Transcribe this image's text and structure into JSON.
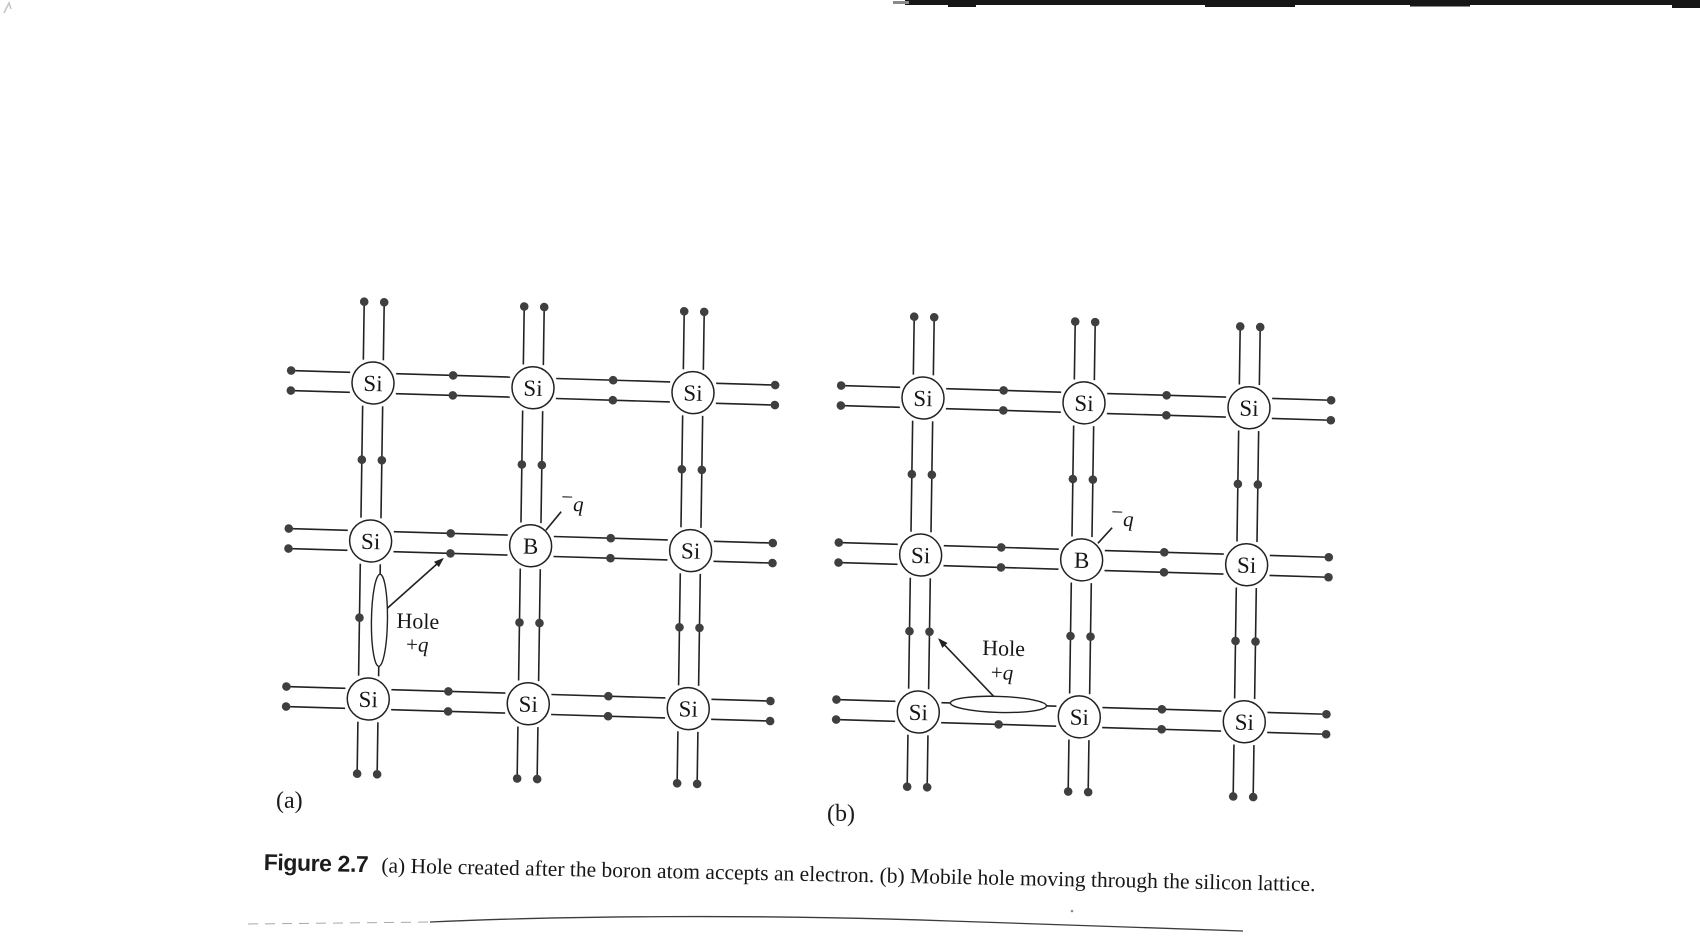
{
  "page": {
    "background": "#ffffff"
  },
  "caption": {
    "figure_label": "Figure 2.7",
    "text": "(a) Hole created after the boron atom accepts an electron. (b) Mobile hole moving through the silicon lattice."
  },
  "artifacts": {
    "top_bar_color": "#161616",
    "bottom_line_color": "#3b3b3b",
    "faint_line_color": "#a9a9a9",
    "corner_mark_color": "#c4c4c4"
  },
  "geometry": {
    "atom_radius": 21,
    "pair_offset": 10,
    "dot_radius": 4.3,
    "line_width": 1.6,
    "stroke": "#222222",
    "dot_color": "#3f3f3f",
    "skew": [
      1,
      0.03,
      -0.015,
      1
    ]
  },
  "diagrams": [
    {
      "id": "a",
      "sublabel": "(a)",
      "origin": {
        "x": 373,
        "y": 383
      },
      "cols": [
        0,
        160,
        320
      ],
      "rows": [
        0,
        158,
        316
      ],
      "atoms": [
        [
          "Si",
          "Si",
          "Si"
        ],
        [
          "Si",
          "B",
          "Si"
        ],
        [
          "Si",
          "Si",
          "Si"
        ]
      ],
      "hole": {
        "orientation": "vertical",
        "cx": 10,
        "cy": 237,
        "rx": 8,
        "ry": 46
      },
      "hole_label": {
        "word": "Hole",
        "charge_plus": "+",
        "charge_q": "q",
        "word_pos": {
          "x": 27,
          "y": 244
        },
        "charge_pos": {
          "x": 37,
          "y": 267
        }
      },
      "arrow": {
        "x1": 12,
        "y1": 230,
        "x2": 72,
        "y2": 174
      },
      "acceptor_label": {
        "minus": "−",
        "q": "q",
        "pos": {
          "x": 190,
          "y": 122
        },
        "leader": {
          "x1": 175,
          "y1": 142,
          "x2": 190,
          "y2": 123
        }
      }
    },
    {
      "id": "b",
      "sublabel": "(b)",
      "origin": {
        "x": 923,
        "y": 398
      },
      "cols": [
        0,
        161,
        326
      ],
      "rows": [
        0,
        157,
        314
      ],
      "atoms": [
        [
          "Si",
          "Si",
          "Si"
        ],
        [
          "Si",
          "B",
          "Si"
        ],
        [
          "Si",
          "Si",
          "Si"
        ]
      ],
      "hole": {
        "orientation": "horizontal",
        "cx": 80,
        "cy": 304,
        "rx": 48,
        "ry": 8
      },
      "hole_label": {
        "word": "Hole",
        "charge_plus": "+",
        "charge_q": "q",
        "word_pos": {
          "x": 63,
          "y": 255
        },
        "charge_pos": {
          "x": 72,
          "y": 279
        }
      },
      "arrow": {
        "x1": 78,
        "y1": 299,
        "x2": 20,
        "y2": 241
      },
      "acceptor_label": {
        "minus": "−",
        "q": "q",
        "pos": {
          "x": 190,
          "y": 122
        },
        "leader": {
          "x1": 177,
          "y1": 140,
          "x2": 191,
          "y2": 124
        }
      }
    }
  ]
}
